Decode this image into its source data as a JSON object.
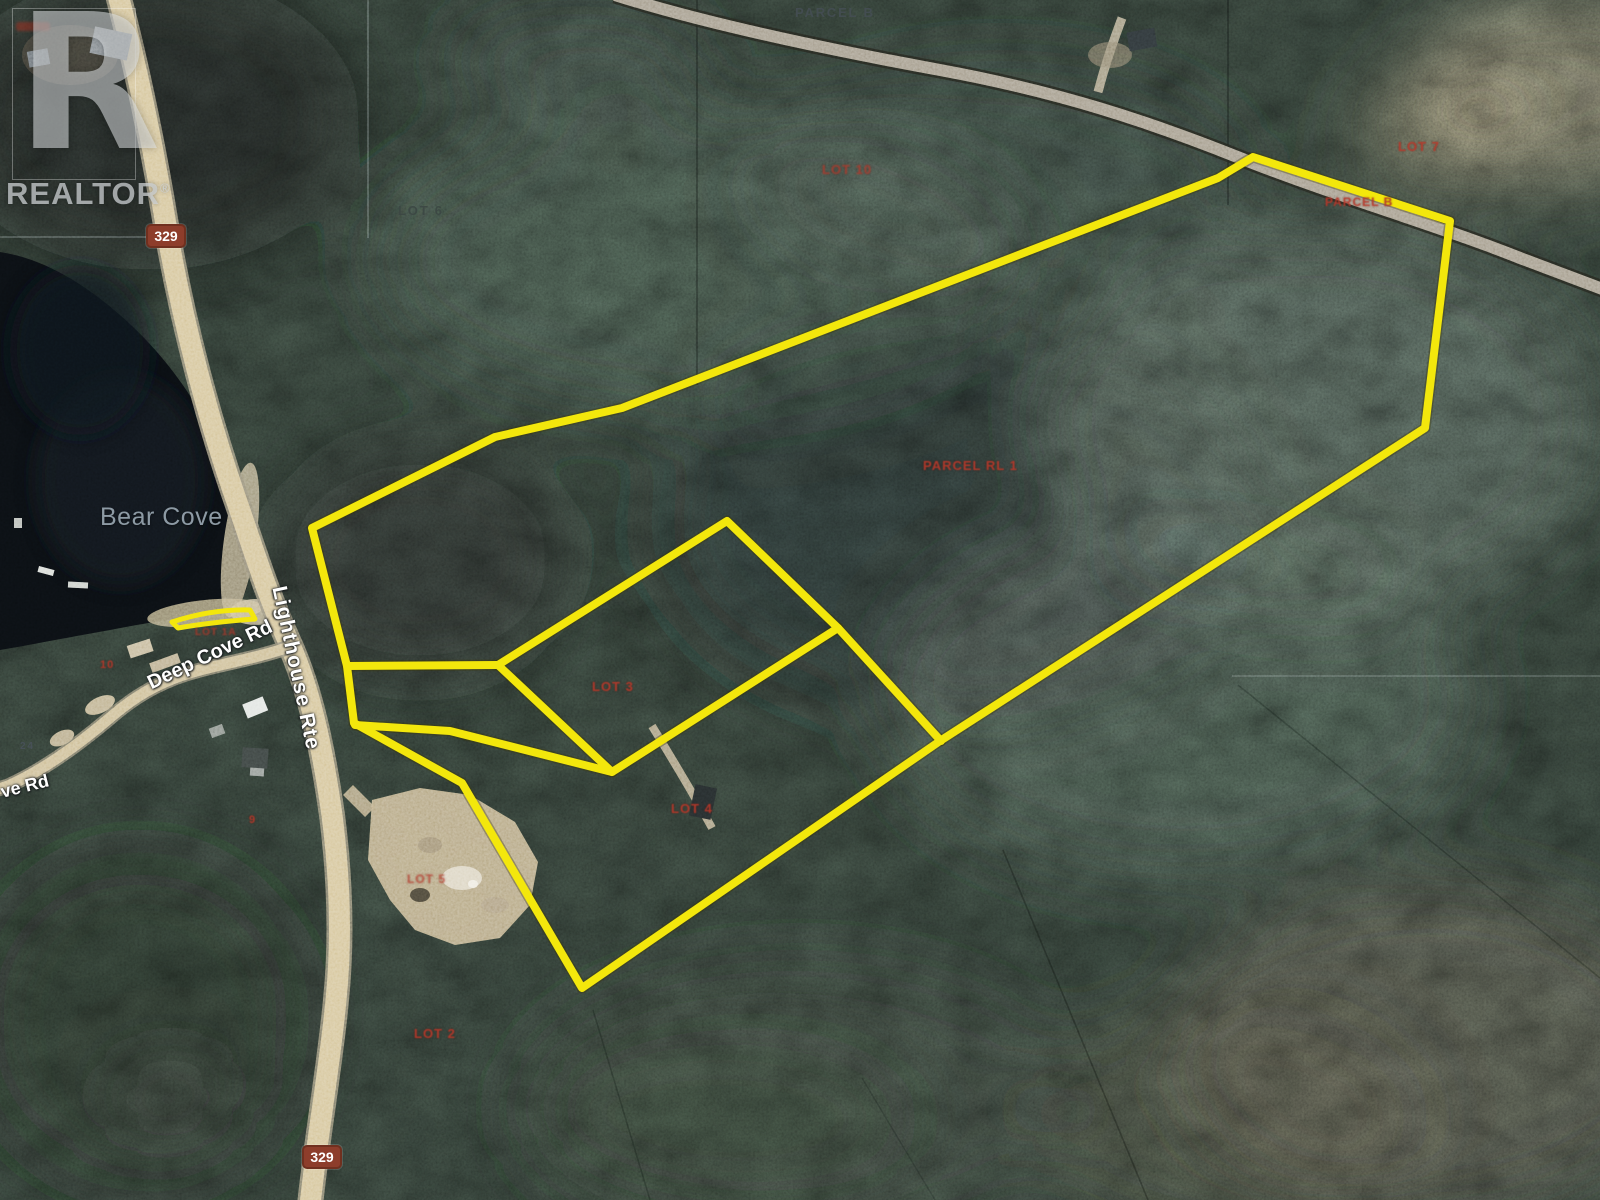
{
  "watermark": {
    "logo_letter": "R",
    "brand": "REALTOR",
    "registered": "®"
  },
  "place_labels": {
    "bear_cove": "Bear Cove"
  },
  "road_labels": {
    "lighthouse_rte": "Lighthouse Rte",
    "deep_cove_rd": "Deep Cove Rd",
    "cove_rd_partial": "ve Rd",
    "route_badge_top": "329",
    "route_badge_bottom": "329"
  },
  "parcel_labels": {
    "parcel_b_top": "PARCEL B",
    "lot_10": "LOT 10",
    "lot_6": "LOT 6",
    "lot_7": "LOT 7",
    "parcel_b_ne": "PARCEL B",
    "parcel_rl_1": "PARCEL RL 1",
    "lot_3": "LOT 3",
    "lot_4": "LOT 4",
    "lot_5": "LOT 5",
    "lot_2": "LOT 2",
    "lot_1a": "LOT 1A",
    "civic_10": "10",
    "civic_9": "9",
    "civic_24": "24"
  },
  "colors": {
    "boundary_yellow": "#f3e70c",
    "parcel_red": "#b8382a",
    "road_tan": "#d6c69c",
    "badge_brown": "#8d3d2b",
    "water_dark": "#0b0f13"
  }
}
